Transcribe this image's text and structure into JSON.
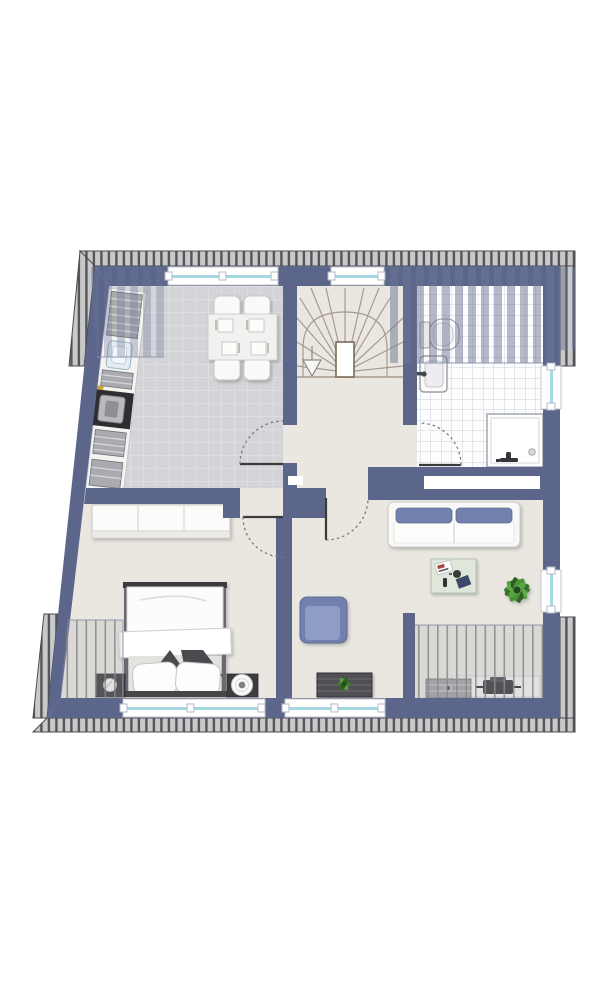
{
  "document": {
    "type": "architectural-floor-plan",
    "style": "top-down furnished color plan, no text labels visible",
    "shape_notes": "trapezoidal attic storey; slanted left exterior wall; hatched roof overhang along top, bottom and corner edges"
  },
  "colors": {
    "background": "#ffffff",
    "wall": "#5c668b",
    "floor_default": "#e9e7e0",
    "kitchen_tile": "#d3d4d7",
    "kitchen_tile_grout": "#e1e2e4",
    "bath_tile": "#fdfdfe",
    "bath_tile_grout": "#ccd1d9",
    "roof_overhang": "#c9c9c9",
    "roof_hatch_tick": "#55565b",
    "window_glazing": "#a5d8e3",
    "sofa_upholstery": "#7382ad",
    "armchair_upholstery": "#7180ac",
    "plant_green": "#3f7d33",
    "stair_line": "#a79b8d",
    "furniture_dark": "#3c3d41",
    "slope_hatch": "#6b7596"
  },
  "rooms": [
    {
      "id": "kitchen-dining",
      "label": "Kitchen / dining room (top left, grey tiled floor)",
      "furniture": [
        "counter run along slanted wall",
        "striped appliance fronts",
        "sink",
        "stove with oven",
        "dining table",
        "4 chairs",
        "4 place settings"
      ],
      "features": [
        "top wall window",
        "sloped-ceiling hatch in top-left corner",
        "door to hall swinging into kitchen"
      ]
    },
    {
      "id": "stair-hall",
      "label": "Stairwell and landing (top centre, beige floor)",
      "furniture": [
        "winder staircase with radial treads",
        "newel post",
        "down arrow"
      ],
      "features": [
        "top wall window"
      ]
    },
    {
      "id": "bathroom",
      "label": "Bathroom (top right, white tiled floor)",
      "furniture": [
        "toilet",
        "washbasin",
        "corner shower with drain"
      ],
      "features": [
        "right wall window",
        "sloped-ceiling hatch across top",
        "door swinging into bathroom",
        "wall niche"
      ]
    },
    {
      "id": "bedroom",
      "label": "Bedroom (bottom left, beige floor)",
      "furniture": [
        "wardrobe",
        "double bed with folded blanket",
        "2 dark accent pillows",
        "2 white pillows",
        "left nightstand with lamp",
        "right nightstand with round lamp"
      ],
      "features": [
        "bottom wall window",
        "sloped-ceiling hatch along left side",
        "door swinging into bedroom"
      ]
    },
    {
      "id": "living-room",
      "label": "Living room (bottom right, beige floor)",
      "furniture": [
        "sofa with two blue bolsters",
        "coffee table with magazine, cup, remote and tablet",
        "potted plant",
        "blue armchair",
        "lowboard with plant",
        "low cabinet under eaves",
        "sideboard",
        "media device"
      ],
      "features": [
        "right wall window",
        "bottom wall window",
        "knee wall",
        "sloped-ceiling hatch in bottom-right corner",
        "door to hall swinging into living room"
      ]
    }
  ],
  "windows": [
    {
      "id": "kitchen-window",
      "wall": "top"
    },
    {
      "id": "stair-window",
      "wall": "top"
    },
    {
      "id": "bathroom-window",
      "wall": "right"
    },
    {
      "id": "living-window-right",
      "wall": "right"
    },
    {
      "id": "bedroom-window",
      "wall": "bottom"
    },
    {
      "id": "living-window-bottom",
      "wall": "bottom"
    }
  ],
  "doors": [
    {
      "id": "kitchen-door",
      "swing": "into kitchen"
    },
    {
      "id": "bedroom-door",
      "swing": "into bedroom"
    },
    {
      "id": "living-room-door",
      "swing": "into living room"
    },
    {
      "id": "bathroom-door",
      "swing": "into bathroom"
    }
  ]
}
